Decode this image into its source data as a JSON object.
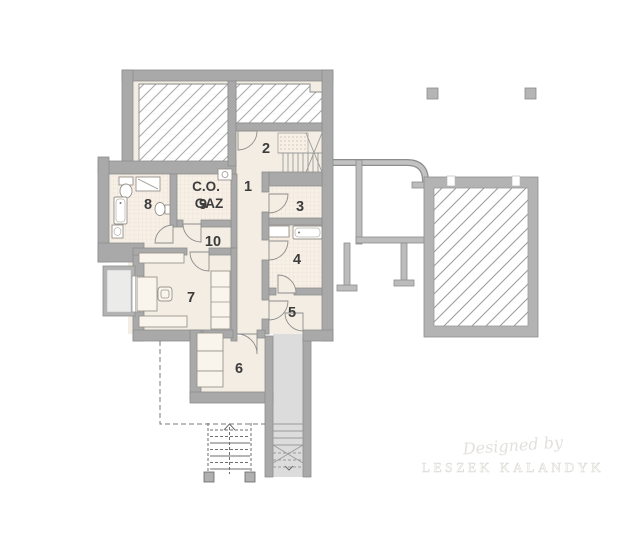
{
  "rooms": {
    "r1": "1",
    "r2": "2",
    "r3": "3",
    "r4": "4",
    "r5": "5",
    "r6": "6",
    "r7": "7",
    "r8": "8",
    "r9": "9",
    "r10": "10"
  },
  "boiler": {
    "line1": "C.O.",
    "line2": "GAZ"
  },
  "watermark": {
    "line1": "Designed by",
    "line2": "LESZEK KALANDYK"
  },
  "colors": {
    "wall": "#a9a9a9",
    "wall_stroke": "#8d8d8d",
    "floor": "#f4ede3",
    "tile_floor": "#f7f0e7",
    "tile_line": "#e8d9ca",
    "hatch_line": "#a8a8a8",
    "stair_fill": "#dcdcdc",
    "label": "#3c3c3c",
    "watermark": "#e3e1dd"
  }
}
